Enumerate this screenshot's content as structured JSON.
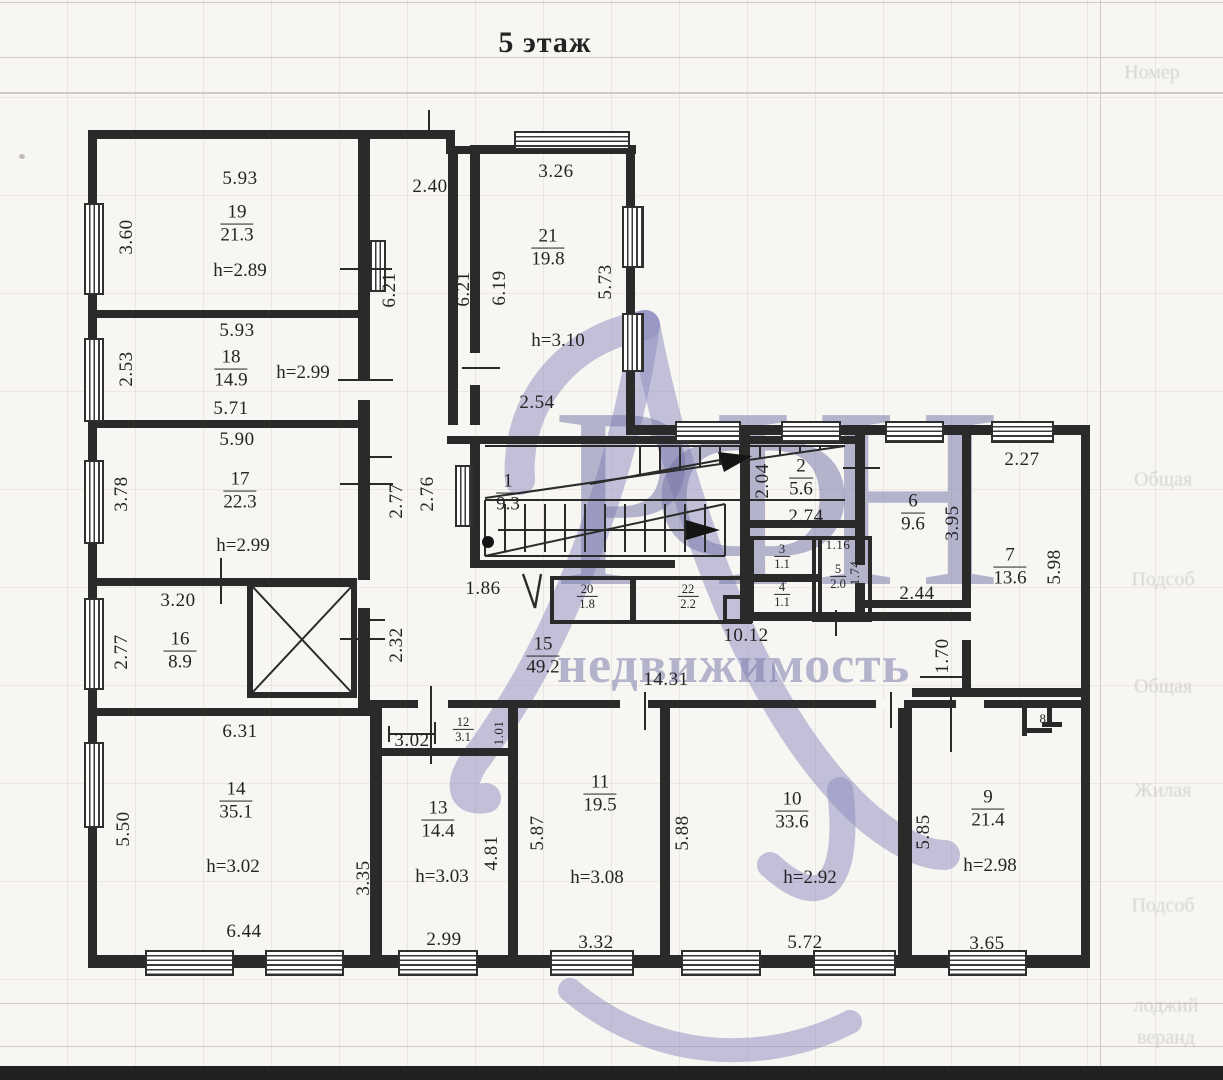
{
  "title": "5 этаж",
  "watermark": {
    "brand": "РФН",
    "word": "недвижимость"
  },
  "rooms": {
    "r1": {
      "num": "1",
      "area": "9.3"
    },
    "r2": {
      "num": "2",
      "area": "5.6",
      "dim_left": "2.04",
      "dim_bottom": "2.74"
    },
    "r3": {
      "num": "3",
      "area": "1.1"
    },
    "r4": {
      "num": "4",
      "area": "1.1"
    },
    "r5": {
      "num": "5",
      "area": "2.0",
      "dim_top": "1.16",
      "dim_right": "1.74"
    },
    "r6": {
      "num": "6",
      "area": "9.6",
      "dim_right": "3.95",
      "dim_bottom": "2.44"
    },
    "r7": {
      "num": "7",
      "area": "13.6",
      "dim_top": "2.27",
      "dim_right": "5.98"
    },
    "r8": {
      "num": "8"
    },
    "r9": {
      "num": "9",
      "area": "21.4",
      "height": "h=2.98",
      "dim_left": "5.85",
      "dim_bottom": "3.65"
    },
    "r10": {
      "num": "10",
      "area": "33.6",
      "height": "h=2.92",
      "dim_left": "5.88",
      "dim_bottom": "5.72"
    },
    "r11": {
      "num": "11",
      "area": "19.5",
      "height": "h=3.08",
      "dim_left": "5.87",
      "dim_bottom": "3.32"
    },
    "r12": {
      "num": "12",
      "area": "3.1",
      "dim_left": "3.02",
      "dim_right": "1.01"
    },
    "r13": {
      "num": "13",
      "area": "14.4",
      "height": "h=3.03",
      "dim_right": "4.81",
      "dim_bottom": "2.99"
    },
    "r14": {
      "num": "14",
      "area": "35.1",
      "height": "h=3.02",
      "dim_top": "6.31",
      "dim_left": "5.50",
      "dim_right": "3.35",
      "dim_bottom": "6.44"
    },
    "r15": {
      "num": "15",
      "area": "49.2"
    },
    "r16": {
      "num": "16",
      "area": "8.9",
      "dim_top": "3.20",
      "dim_left": "2.77"
    },
    "r17": {
      "num": "17",
      "area": "22.3",
      "height": "h=2.99",
      "dim_top": "5.90",
      "dim_left": "3.78",
      "dim_right": "2.77"
    },
    "r18": {
      "num": "18",
      "area": "14.9",
      "height": "h=2.99",
      "dim_top": "5.93",
      "dim_left": "2.53",
      "dim_bottom": "5.71"
    },
    "r19": {
      "num": "19",
      "area": "21.3",
      "height": "h=2.89",
      "dim_top": "5.93",
      "dim_left": "3.60"
    },
    "r20": {
      "num": "20",
      "area": "1.8"
    },
    "r21": {
      "num": "21",
      "area": "19.8",
      "height": "h=3.10",
      "dim_top": "3.26",
      "dim_left": "6.19",
      "dim_right": "5.73",
      "dim_bottom": "2.54"
    },
    "r22": {
      "num": "22",
      "area": "2.2"
    }
  },
  "dims": {
    "top_width": "2.40",
    "shaft_left": "6.21",
    "shaft_right": "6.21",
    "stair_left": "2.76",
    "hall_left": "2.32",
    "hall_width": "1.86",
    "corridor_right": "10.12",
    "corridor_total": "14.31",
    "niche_right": "1.70"
  },
  "background": {
    "table_labels": [
      "Номер",
      "Общая",
      "Подсоб",
      "Общая",
      "Жилая",
      "Подсоб",
      "лоджий",
      "веранд"
    ]
  }
}
